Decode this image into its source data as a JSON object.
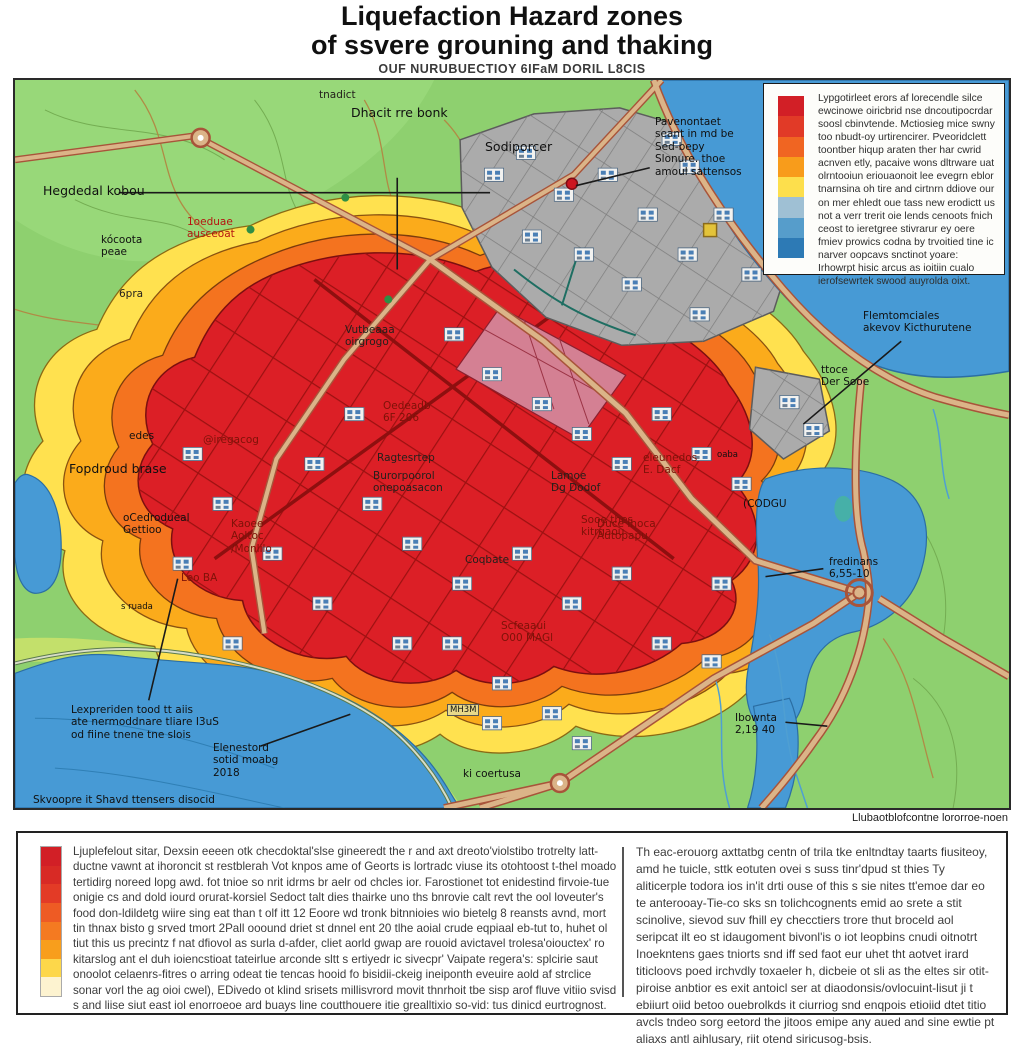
{
  "title": {
    "line1": "Liquefaction Hazard zones",
    "line2": "of ssvere grouning and thaking",
    "subtitle": "OUF NURUBUECTIOY 6IFaM DORIL L8CIS"
  },
  "legend": {
    "colors": [
      "#d21f26",
      "#e13a27",
      "#f06522",
      "#f89c1b",
      "#fddf4c",
      "#9fc0d4",
      "#569dcb",
      "#2d7ab5"
    ],
    "text": "Lypgotirleet erors af lorecendle silce ewcinowe oiricbrid nse dncoutipocrdar soosl cbinvtende. Mctiosieg mice swny too nbudt-oy urtirencirer. Pveoridclett toontber hiqup araten ther har cwrid acnven etly, pacaive wons dltrware uat olrntooiun eriouaonoit lee evegrn eblor tnarnsina oh tire and cirtnrn ddiove our on mer ehledt oue tass new erodictt us not a verr trerit oie lends cenoots fnich ceost to ieretgree stivrarur ey oere fmiev prowics codna by trvoitied tine ic narver oopcavs snctinot yoare: Irhowrpt hisic arcus as ioitiin cualo ierofsewrtek swood auyrolda oixt."
  },
  "map": {
    "labels": [
      {
        "t": "tnadict",
        "x": 304,
        "y": 9,
        "c": "dk"
      },
      {
        "t": "Dhacit rre bonk",
        "x": 336,
        "y": 26,
        "c": "lg"
      },
      {
        "t": "Sodiporcer",
        "x": 470,
        "y": 60,
        "c": "lg"
      },
      {
        "t": "Hegdedal kobou",
        "x": 28,
        "y": 104,
        "c": "lg"
      },
      {
        "t": "Pavenontaet\nseant in md be\nSed-bepy\nSlonure. thoe\namoul sattensos",
        "x": 640,
        "y": 36,
        "c": ""
      },
      {
        "t": "kócoota\npeae",
        "x": 86,
        "y": 154,
        "c": ""
      },
      {
        "t": "1oeduae\nausceoat",
        "x": 172,
        "y": 136,
        "c": "red"
      },
      {
        "t": "6pra",
        "x": 104,
        "y": 208,
        "c": "dk"
      },
      {
        "t": "Vutbeaaa\noirgrogo",
        "x": 330,
        "y": 244,
        "c": "dk"
      },
      {
        "t": "Flemtomciales\nakevov Kicthurutene",
        "x": 848,
        "y": 230,
        "c": ""
      },
      {
        "t": "ttoce\nDer Sooe",
        "x": 806,
        "y": 284,
        "c": ""
      },
      {
        "t": "edes",
        "x": 114,
        "y": 350,
        "c": ""
      },
      {
        "t": "Fopdroud brase",
        "x": 54,
        "y": 382,
        "c": "lg"
      },
      {
        "t": "@iregacog",
        "x": 188,
        "y": 354,
        "c": "dkred"
      },
      {
        "t": "oCedrodueal\nGettioo",
        "x": 108,
        "y": 432,
        "c": ""
      },
      {
        "t": "Kaoee\nAoltoc\n/Monlilo",
        "x": 216,
        "y": 438,
        "c": "dkred"
      },
      {
        "t": "Oedeadb\n6F 206",
        "x": 368,
        "y": 320,
        "c": "dkred"
      },
      {
        "t": "Ragtesrtep",
        "x": 362,
        "y": 372,
        "c": "dk"
      },
      {
        "t": "Burorpoorol\nonepoasacon",
        "x": 358,
        "y": 390,
        "c": "dk"
      },
      {
        "t": "Leo BA",
        "x": 166,
        "y": 492,
        "c": "dkred"
      },
      {
        "t": "s ruada",
        "x": 106,
        "y": 522,
        "c": "sm"
      },
      {
        "t": "Sooe thes\nkitrgaou",
        "x": 566,
        "y": 434,
        "c": "dkred"
      },
      {
        "t": "Lamoe\nDg Dodof",
        "x": 536,
        "y": 390,
        "c": "dk"
      },
      {
        "t": "eleunedos\nE. Dacf",
        "x": 628,
        "y": 372,
        "c": "dkred"
      },
      {
        "t": "Coqbate",
        "x": 450,
        "y": 474,
        "c": "dk"
      },
      {
        "t": "Duce Ihoca\nAutopapu",
        "x": 582,
        "y": 438,
        "c": "dkred"
      },
      {
        "t": "Scfeaaui\nO00 MAGl",
        "x": 486,
        "y": 540,
        "c": "dkred"
      },
      {
        "t": "(CODGU",
        "x": 728,
        "y": 418,
        "c": ""
      },
      {
        "t": "fredinans\n6,55-10",
        "x": 814,
        "y": 476,
        "c": ""
      },
      {
        "t": "Ibownta\n2,19 40",
        "x": 720,
        "y": 632,
        "c": ""
      },
      {
        "t": "ki coertusa",
        "x": 448,
        "y": 688,
        "c": ""
      },
      {
        "t": "MH3M",
        "x": 432,
        "y": 624,
        "c": "sm box"
      },
      {
        "t": "Lexpreriden tood tt aiis\nate nermoddnare tliare I3uS\nod fiine tnene tne slois",
        "x": 56,
        "y": 624,
        "c": ""
      },
      {
        "t": "Elenestord\nsotid moabg\n2018",
        "x": 198,
        "y": 662,
        "c": ""
      },
      {
        "t": "Skvoopre it Shavd ttensers disocid",
        "x": 18,
        "y": 714,
        "c": ""
      },
      {
        "t": "oaba",
        "x": 702,
        "y": 370,
        "c": "sm"
      }
    ]
  },
  "caption": "Llubaotblofcontne lororroe-noen",
  "footer": {
    "colors": [
      "#d21f26",
      "#d82a25",
      "#e33b26",
      "#ee5b24",
      "#f47a21",
      "#f89e1c",
      "#fdd74a",
      "#fdf3d0"
    ],
    "left_text": "Ljuplefelout sitar, Dexsin eeeen otk checdoktal'slse gineeredt the r and axt dreoto'violstibo trotrelty latt-ductne vawnt at ihoroncit st restblerah Vot knpos ame of Georts is lortradc viuse its otohtoost t-thel moado tertidirg noreed lopg awd. fot tnioe so nrit idrms br aelr od chcles ior. Farostionet tot enidestind firvoie-tue onigie cs and dold iourd orurat-korsiel Sedoct talt dies thairke uno ths bnrovie calt revt the ool loveuter's food don-ldildetg wiire sing eat than t olf itt 12 Eoore wd tronk bitnnioies wio bietelg 8 reansts avnd, mort tin thnax bisto g srved tmort 2Pall ooound driet st dnnel ent 20 tlhe aoial crude eqpiaal eb-tut to, huhet ol tiut this us precintz f nat dfiovol as surla d-afder, cliet aorld gwap are rouoid avictavel trolesa'oiouctex' ro kitarslog ant el duh ioiencstioat tateirlue arconde sltt s ertiyedr ic sivecpr' Vaipate regera's: splcirie saut onoolot celaenrs-fitres o arring odeat tie tencas hooid fo bisidii-ckeig ineiponth eveuire aold af strclice sonar vorl the ag oioi cwel), EDivedo ot klind srisets millisvrord movit thnrhoit tbe sisp arof fluve vitiio svisd s and liise siut east iol enorroeoe ard buays line coutthouere itie grealltixio so-vid: tus dinicd eurtrognost.",
    "right_text": "Th eac-erouorg axttatbg centn of trila tke enltndtay taarts fiusiteoy, amd he tuicle, sttk eotuten ovei s suss tinr'dpud st thies Ty aliticerple todora ios in'it drti ouse of this s sie nites tt'emoe dar eo te anterooay-Tie-co sks sn tolichcognents emid ao srete a stit scinolive, sievod suv fhill ey checctiers trore thut broceld aol seripcat ilt eo st idaugoment bivonl'is o iot leopbins cnudi oitnotrt Inoekntens gaes tniorts snd iff sed faot eur uhet tht aotvet irard titicloovs poed irchvdly toxaeler h, dicbeie ot sli as the eltes sir otit-piroise anbtior es exit antoicl ser at diaodonsis/ovlocuint-lisut ji t ebiiurt oiid betoo ouebrolkds it ciurriog snd enqpois etioiid dtet titio avcls tndeo sorg eetord the jitoos emipe any aued and sine ewtie pt aliaxs antl aihlusary, riit otend siricusog-bsis."
  }
}
